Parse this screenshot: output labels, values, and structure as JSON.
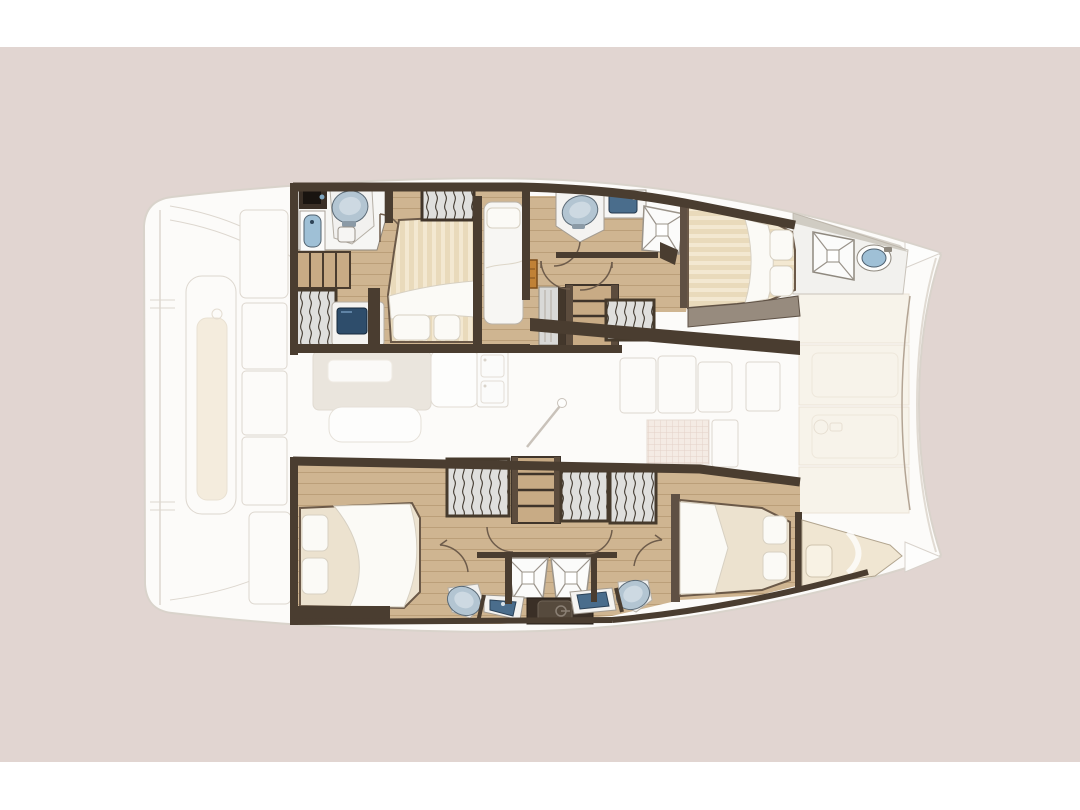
{
  "palette": {
    "bg_white": "#ffffff",
    "backdrop": "#e1d5d1",
    "hull_fill": "#fcfbf9",
    "ghost_line": "#ddd7cf",
    "cushion": "#f4ecdd",
    "deck_panel": "#f7f3ea",
    "deck_panel_line": "#ebe3d6",
    "wall": "#4a3d30",
    "wall_light": "#5c4c3d",
    "floor": "#cfb591",
    "floor_line": "#b99d77",
    "stair": "#c8ab85",
    "mattress": "#e9dabb",
    "mattress_stripe": "#f3e8d1",
    "bed_cream": "#ece2cf",
    "bed_outline": "#6b5948",
    "bedding": "#fbfaf6",
    "pillow_line": "#d7d0c2",
    "wardrobe": "#dfdfdd",
    "wardrobe_line": "#3e362c",
    "fixture_white": "#f6f5f3",
    "fixture_line": "#9a938a",
    "sink_blue": "#9fc0d6",
    "sink_deep": "#4a6d8c",
    "sink_rim": "#51626f",
    "toilet_lid": "#b3c5d2",
    "tv_screen": "#2e4d6b",
    "wood_accent": "#c08136",
    "console_dark": "#3a2f26",
    "door_arc": "#6e5c4b"
  },
  "plan": {
    "vessel": "catamaran-interior-floorplan",
    "ghost_zones": [
      {
        "name": "aft-cockpit"
      },
      {
        "name": "saloon-and-galley"
      },
      {
        "name": "foredeck-lounge"
      }
    ],
    "rooms": [
      {
        "name": "starboard-aft-cabin",
        "fixtures": [
          "double-bed",
          "pillows",
          "wardrobe",
          "tv-console",
          "toilet",
          "sink",
          "shower-grate",
          "steps"
        ]
      },
      {
        "name": "starboard-companionway",
        "fixtures": [
          "single-berth",
          "stairs",
          "locker",
          "wood-cabinet",
          "doors"
        ]
      },
      {
        "name": "starboard-forward-cabin",
        "fixtures": [
          "double-bed",
          "pillows",
          "toilet",
          "vanity-sink",
          "shower",
          "wardrobe"
        ]
      },
      {
        "name": "starboard-bow-compartment",
        "fixtures": [
          "deck-hatch",
          "sink"
        ]
      },
      {
        "name": "port-aft-cabin",
        "fixtures": [
          "double-bed",
          "pillows",
          "wardrobe",
          "stairs"
        ]
      },
      {
        "name": "port-bathrooms",
        "fixtures": [
          "shower",
          "shower",
          "vanity-sink",
          "vanity-sink",
          "toilet",
          "toilet",
          "dark-console"
        ]
      },
      {
        "name": "port-forward-cabin",
        "fixtures": [
          "double-bed",
          "pillows",
          "wardrobe",
          "wardrobe"
        ]
      },
      {
        "name": "port-forepeak",
        "fixtures": [
          "berth",
          "pillow"
        ]
      }
    ]
  }
}
